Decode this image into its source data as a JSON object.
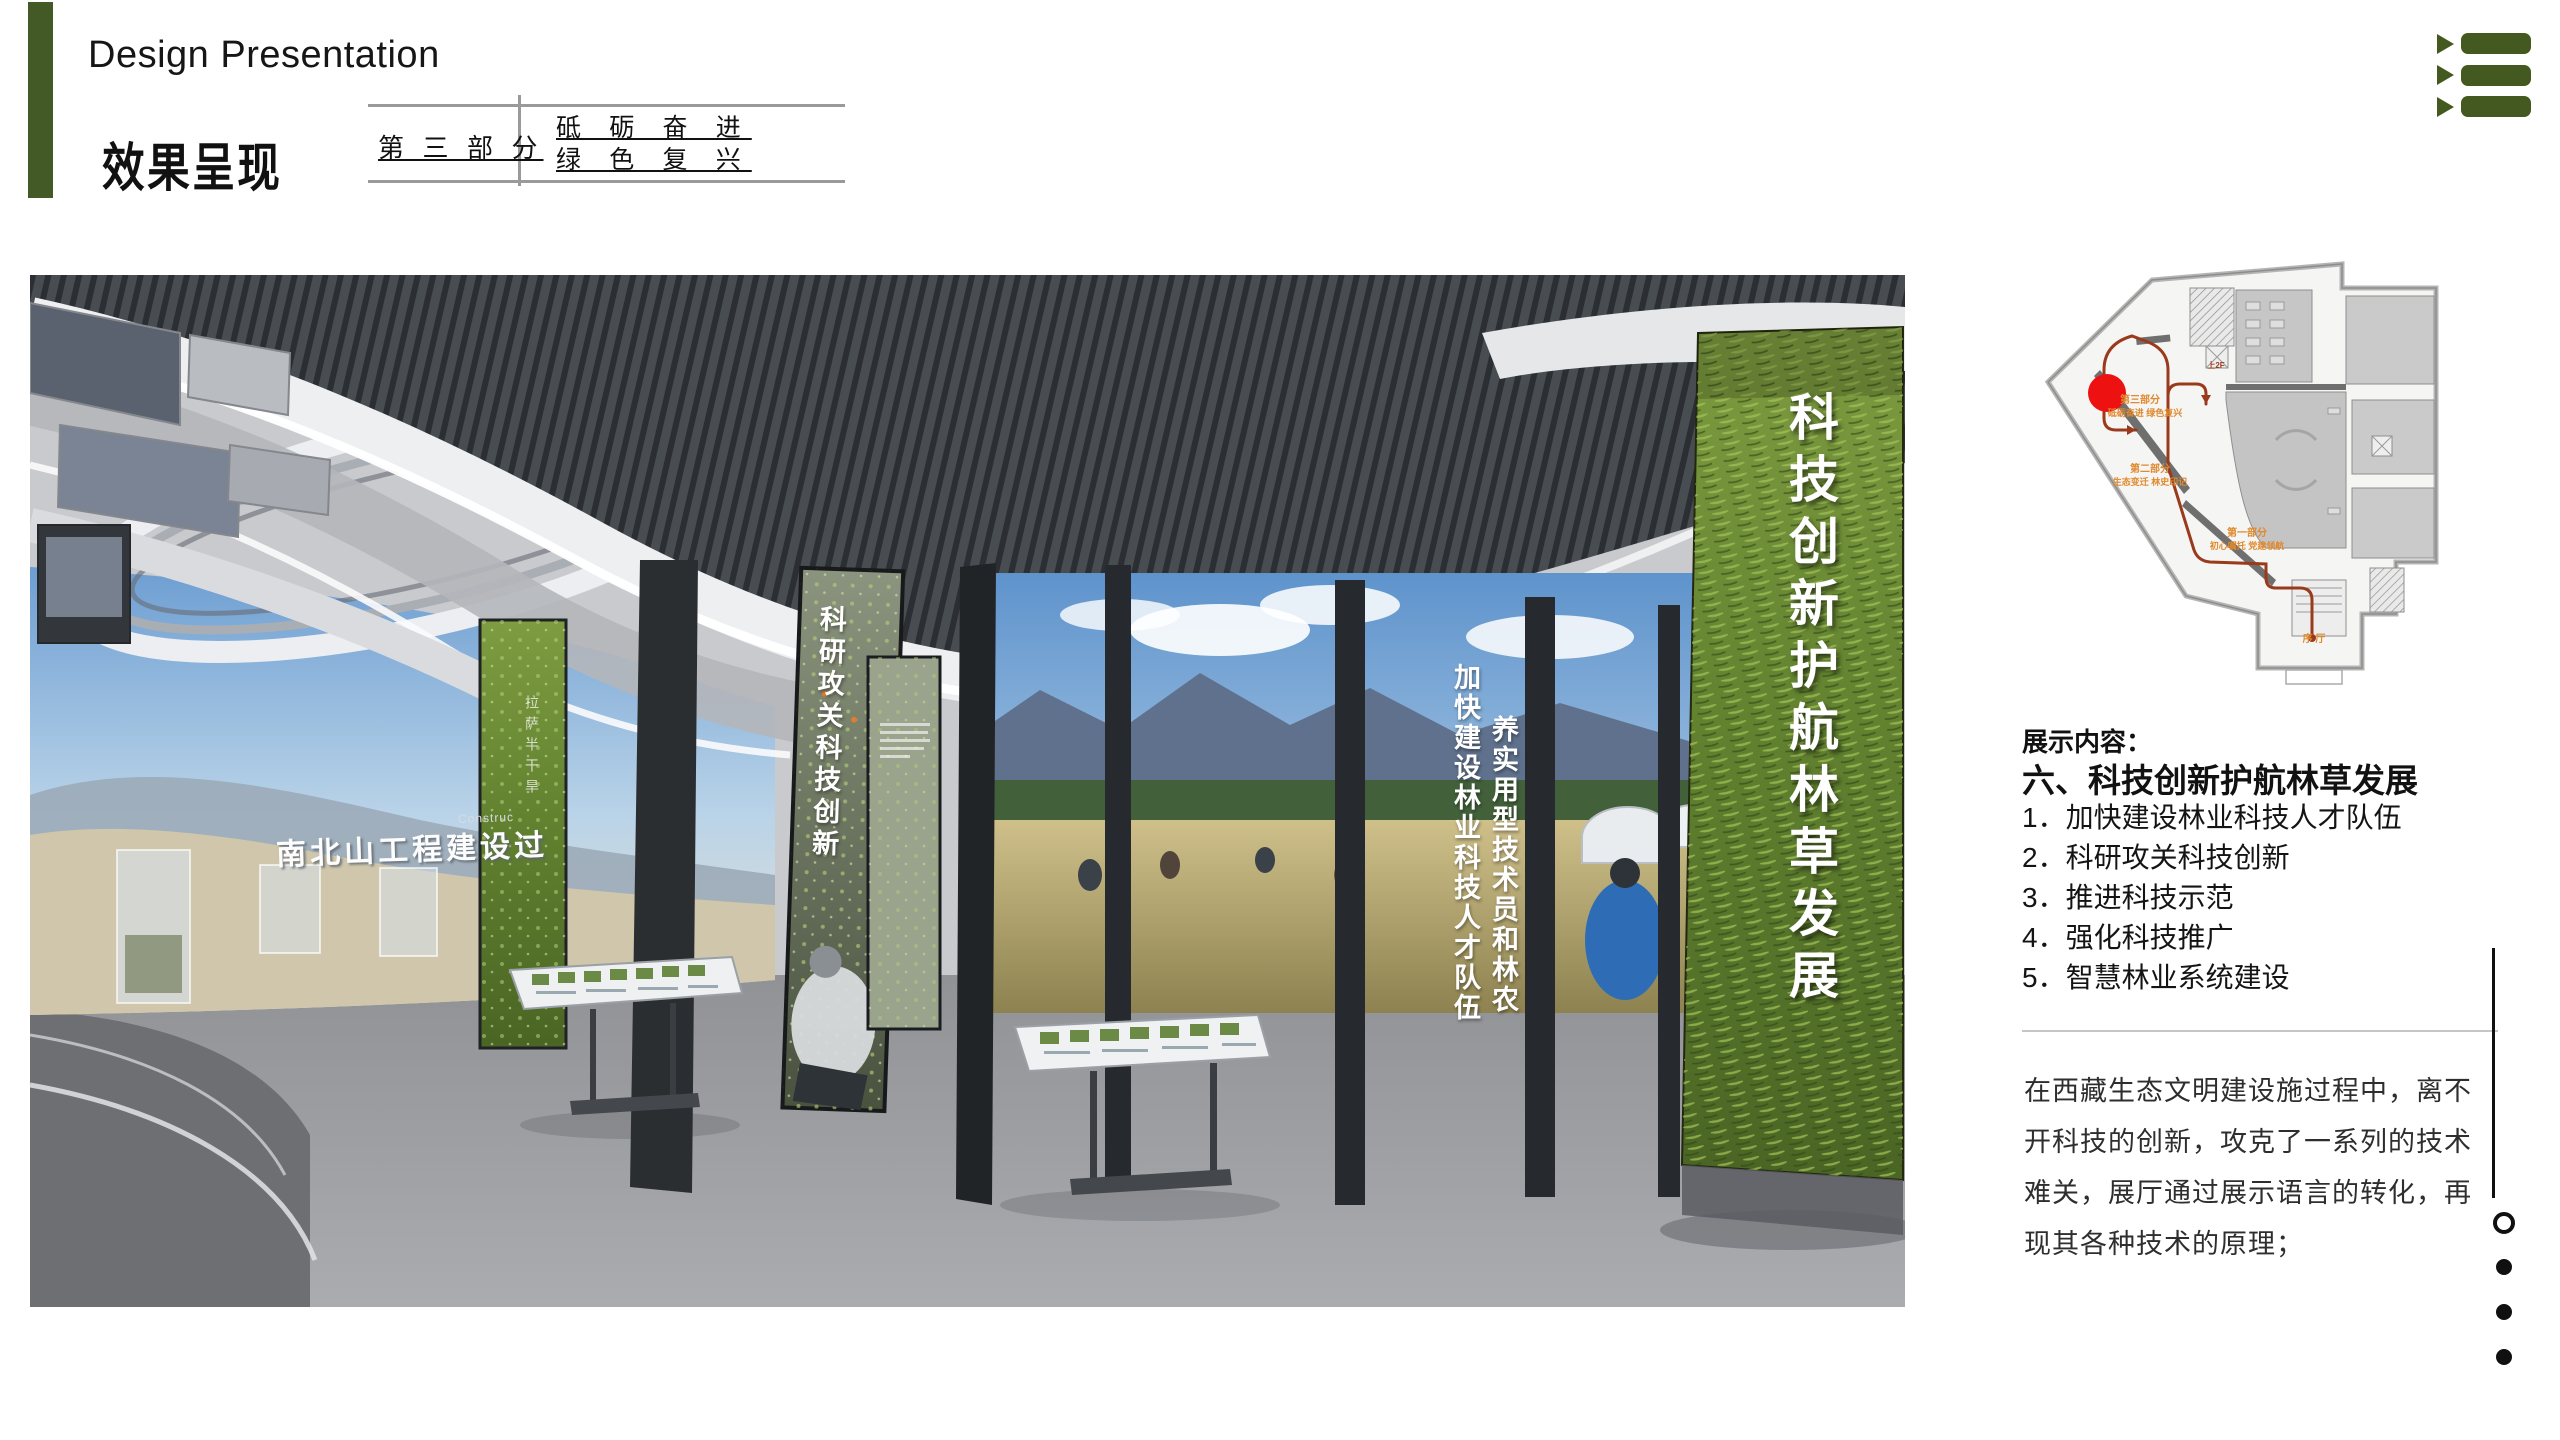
{
  "header": {
    "en_title": "Design Presentation",
    "cn_title": "效果呈现",
    "part_label": "第 三 部 分",
    "slogan_line1": "砥 砺 奋 进",
    "slogan_line2": "绿 色 复 兴"
  },
  "colors": {
    "accent_green": "#445a26",
    "toc_green": "#44591f",
    "route_red": "#9a3a1c",
    "marker_red": "#ee1111",
    "plan_label_orange": "#e0892e"
  },
  "render": {
    "big_panel_text": "科技创新护航林草发展",
    "talent_col1": "加快建设林业科技人才队伍",
    "talent_col2": "养实用型技术员和林农",
    "research_text": "科研攻关科技创新",
    "wall_title": "南北山工程建设过",
    "wall_title_en": "Construc",
    "side_faint_text": "拉萨半干旱"
  },
  "floorplan": {
    "labels": {
      "part3": "第三部分",
      "part3_sub": "砥砺奋进 绿色复兴",
      "part2": "第二部分",
      "part2_sub": "生态变迁 林史印记",
      "part1": "第一部分",
      "part1_sub": "初心嘱托 党建领航",
      "lobby": "序 厅",
      "upstairs": "上2F"
    }
  },
  "content": {
    "heading": "展示内容：",
    "section_title": "六、科技创新护航林草发展",
    "items": [
      "1．加快建设林业科技人才队伍",
      "2．科研攻关科技创新",
      "3．推进科技示范",
      "4．强化科技推广",
      "5．智慧林业系统建设"
    ],
    "paragraph_lines": [
      "在西藏生态文明建设施过程中，离不",
      "开科技的创新，攻克了一系列的技术",
      "难关，展厅通过展示语言的转化，再",
      "现其各种技术的原理；"
    ]
  },
  "page_nav": {
    "count": 4,
    "active_index": 0
  }
}
